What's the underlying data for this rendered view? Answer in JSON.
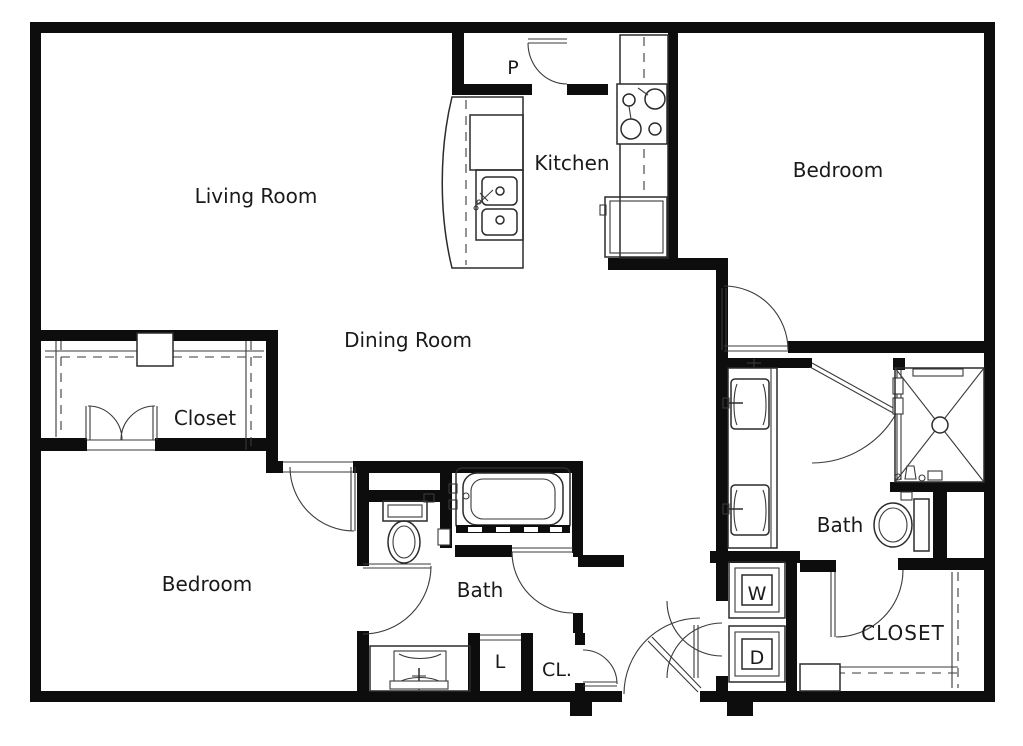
{
  "title": "Two bedroom apartment floor plan",
  "labels": {
    "living_room": "Living Room",
    "kitchen": "Kitchen",
    "bedroom_top": "Bedroom",
    "dining_room": "Dining Room",
    "closet_left": "Closet",
    "bedroom_bottom": "Bedroom",
    "bath_bottom": "Bath",
    "bath_right": "Bath",
    "closet_right": "CLOSET",
    "pantry": "P",
    "linen": "L",
    "closet_small": "CL.",
    "washer": "W",
    "dryer": "D"
  },
  "colors": {
    "wall": "#0d0d0d",
    "line": "#2b2b2b",
    "background": "#ffffff"
  }
}
